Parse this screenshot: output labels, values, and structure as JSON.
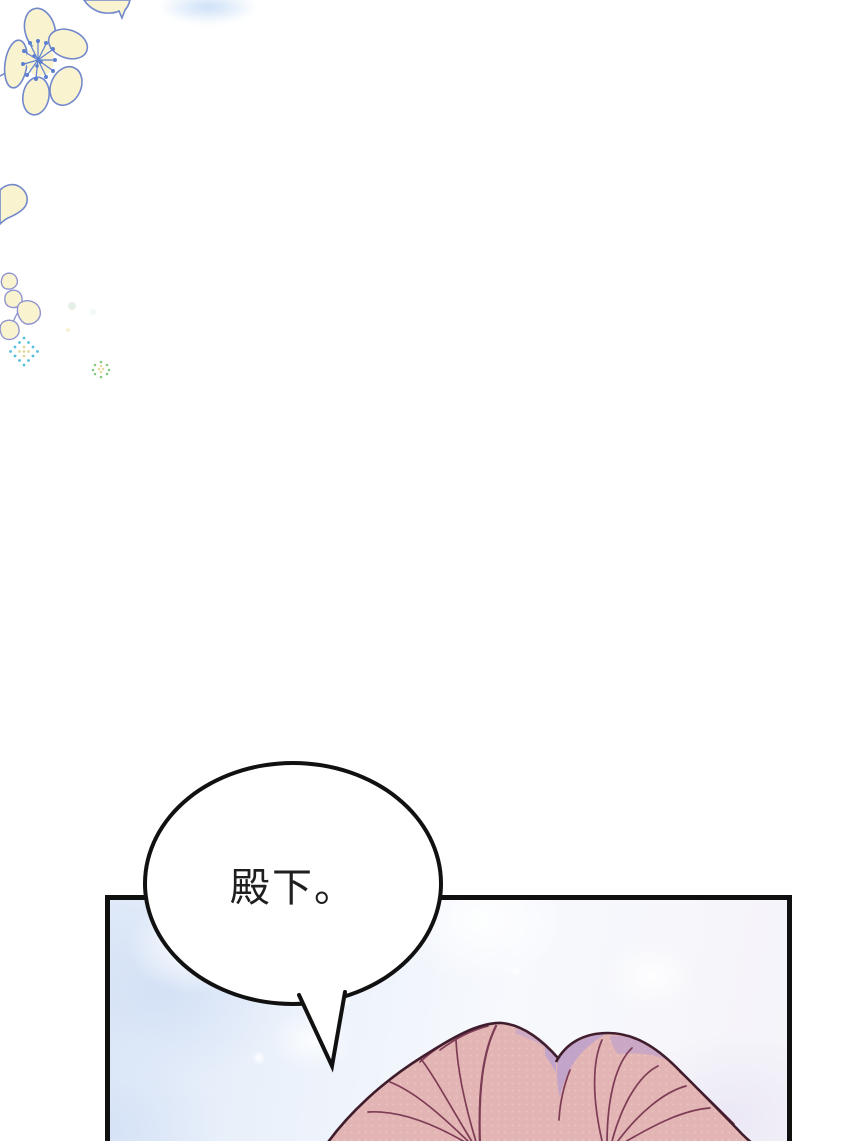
{
  "page": {
    "width": 850,
    "height": 1141,
    "background": "#ffffff",
    "kind": "webtoon-comic-page"
  },
  "speech_bubble": {
    "text": "殿下。",
    "fill": "#ffffff",
    "border_color": "#111111",
    "text_color": "#1f1f1f"
  },
  "panel": {
    "border_color": "#101010",
    "background_base": "#e7eefa"
  },
  "decor": {
    "flower_fill": "#faf3cf",
    "flower_outline": "#7288cc",
    "small_flower_outline": "#9094d0",
    "stamen_color": "#5d7fd0",
    "halftone_cyan": "#41b9d9",
    "halftone_green": "#72c06e",
    "halftone_yellow": "#e0d78e",
    "watercolor_blue": "#cfe0f5"
  },
  "character": {
    "hair_base": "#e2b4b4",
    "hair_light": "#f2d2cc",
    "hair_shadow": "#b79dd1",
    "hair_strand": "#7d3c55",
    "hair_outline": "#401d2c"
  }
}
